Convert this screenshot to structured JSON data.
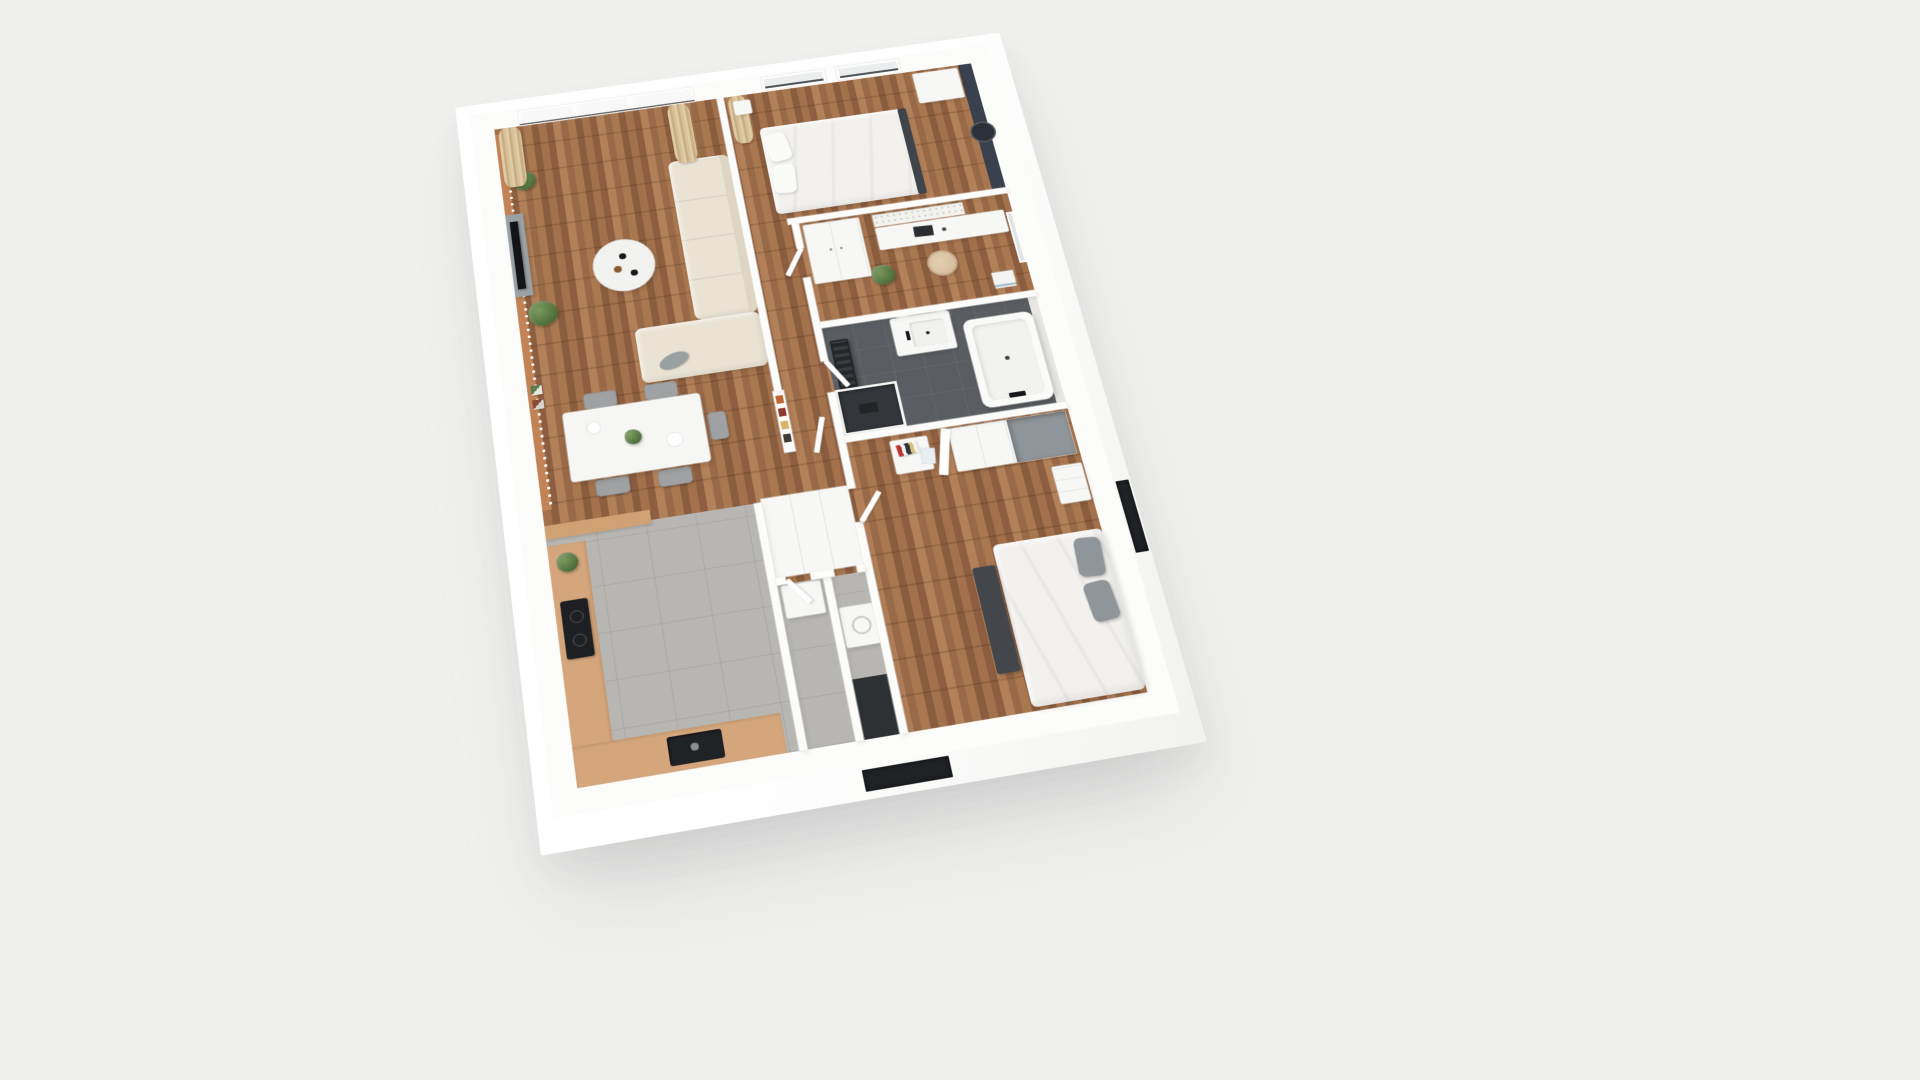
{
  "scene": {
    "name": "3D apartment floor plan render",
    "view": "overhead oblique 3D cutaway, plan rotated slightly counter-clockwise",
    "background_color": "#f0f0ee"
  },
  "palette": {
    "bg": "#f0f0ee",
    "wall": "#fcfcfb",
    "wall-edge": "#e8e8e5",
    "wood-a": "#a3714c",
    "wood-b": "#8d5f40",
    "wood-c": "#b28059",
    "wood-line": "#3a1e0c2e",
    "tile": "#b7b6b2",
    "bath-tile": "#5a5d61",
    "counter": "#d5a67c",
    "accent-terracotta": "#c28457",
    "accent-navy": "#3a414e",
    "sofa": "#eae3d4",
    "curtain-a": "#e0cda8",
    "curtain-b": "#c9af82",
    "plant-a": "#7a9a5c",
    "plant-b": "#4c6b3a",
    "chair": "#9fa1a2",
    "dark": "#202326",
    "bench": "#43474c",
    "bed-duvet": "#f2f1ee",
    "pillow-gray": "#90959a",
    "shower": "#33363a",
    "marble": "#e9e7e3",
    "glass": "#f7f8f7",
    "white-furn": "#f7f7f5"
  },
  "building": {
    "name": "Apartment with white exterior walls",
    "exterior": {
      "wall_color": "#ffffff",
      "openings": [
        "dark window opening on bottom facade",
        "dark window opening on right facade"
      ]
    }
  },
  "rooms": {
    "living": {
      "name": "Living room / dining area",
      "floor": "wood parquet",
      "furniture": {
        "window_wall": "floor-to-ceiling sliding glass doors",
        "curtains": "beige curtains at both window ends",
        "sofa": "L-shaped cream fabric sofa with grey cushion",
        "coffee_table": "round white coffee table with cups",
        "tv_unit": "grey TV lowboard with flat screen TV",
        "accent_wall": "terracotta accent wall",
        "plants": "two potted green plants",
        "wall_art": "two small framed pictures",
        "dining_table": "white dining table with centerpiece plant and plates",
        "dining_chairs": "four grey chairs and one stool",
        "hall_shelf": "small shelf with orange, red and tan books"
      }
    },
    "bedroom1": {
      "name": "Bedroom 1",
      "floor": "wood parquet",
      "furniture": {
        "bed": "double bed, white duvet, two pillows, dark footboard",
        "accent_wall": "dark navy accent wall with round mirror",
        "windows": "two framed windows on top wall",
        "curtain": "beige curtain",
        "closet": "white closet at corner",
        "nightstand": "small white nightstand"
      }
    },
    "office": {
      "name": "Home office",
      "floor": "wood parquet",
      "furniture": {
        "desk": "white desk with laptop",
        "chair": "beige swivel office chair",
        "wardrobe": "white two-door wardrobe",
        "pegboard": "white perforated pegboard",
        "plant": "potted plant",
        "books": "stack of magazines on floor",
        "window": "window on right wall"
      }
    },
    "bathroom": {
      "name": "Bathroom",
      "floor": "dark grey tile",
      "furniture": {
        "vanity": "white vanity with basin, black faucet and mirror with two globe lights",
        "bathtub": "white bathtub with black faucet",
        "shower": "walk-in shower with black tile and white frame",
        "radiator": "black ladder towel radiator",
        "marble_wall": "light marble wall strip"
      }
    },
    "bedroom2": {
      "name": "Bedroom 2",
      "floor": "wood parquet",
      "furniture": {
        "bed": "double bed, white duvet, grey pillows",
        "bench": "dark grey bench at foot of bed",
        "wardrobe": "white wardrobe with one door open showing grey interior",
        "nightstand": "white nightstand with colorful books",
        "dresser": "small white dresser"
      }
    },
    "kitchen": {
      "name": "Kitchen",
      "floor": "grey tile",
      "furniture": {
        "counter": "tan L-shaped countertop",
        "cooktop": "black induction cooktop",
        "sink": "black kitchen sink",
        "bar": "tan half wall",
        "plant": "small plant on counter"
      }
    },
    "utility": {
      "name": "Entry / utility rooms",
      "floor": "grey tile",
      "furniture": {
        "closet": "white built-in storage closet block",
        "cabinet": "white cabinet",
        "washer": "white washing machine",
        "mat": "dark floor area at entry"
      }
    },
    "hallway": {
      "name": "Hallway",
      "floor": "wood parquet",
      "furniture": {
        "doors": "several white doors ajar"
      }
    }
  }
}
